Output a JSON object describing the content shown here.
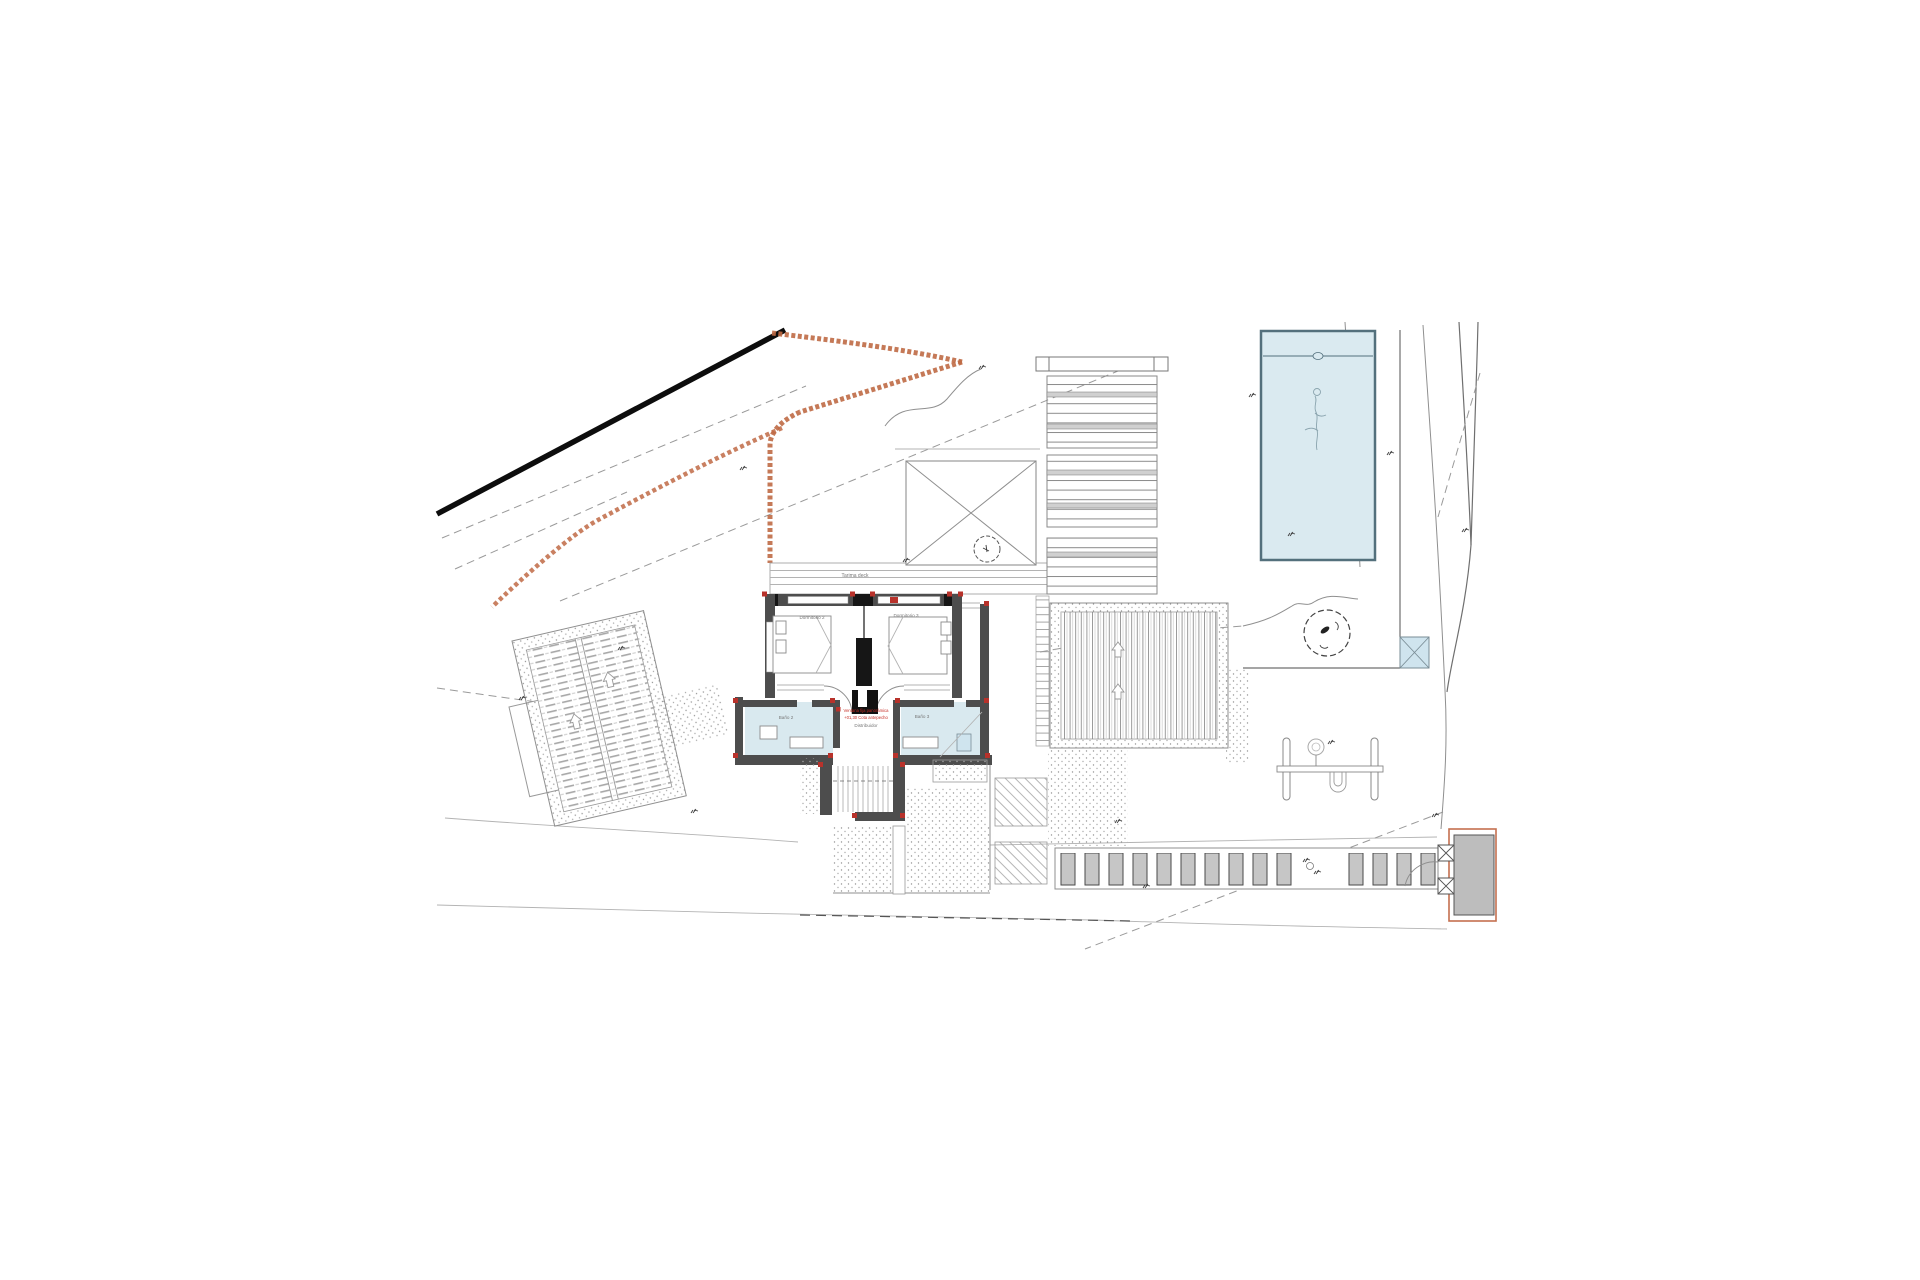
{
  "drawing": {
    "labels": {
      "deck": "Tarima deck",
      "bedroom_left": "Dormitorio 2",
      "bedroom_right": "Dormitorio 3",
      "bath_left": "Baño 2",
      "bath_right": "Baño 3",
      "hall": "Distribuidor"
    },
    "red_note": {
      "line1": "Ventana fija panorámica",
      "line2": "+01,30 Cota antepecho"
    },
    "colors": {
      "wall_gray": "#4d4d4d",
      "marker_red": "#b8322b",
      "boundary_orange": "#bf6a45",
      "pool_water": "#daeaf0",
      "bath_floor": "#d9e9ef",
      "utility_square_blue": "#cfe4ee",
      "paver_gray": "#c6c6c6",
      "gate_outline": "#c4704f"
    },
    "symbols": [
      "pool",
      "swimmer-figure",
      "tree",
      "swing-set",
      "gate",
      "driveway-pavers",
      "pergola-slats",
      "louver-bands",
      "skylight-x",
      "stairs",
      "double-bed",
      "wc",
      "washbasin",
      "boundary-road-line",
      "retaining-boundary",
      "contour-lines",
      "utility-square"
    ]
  }
}
